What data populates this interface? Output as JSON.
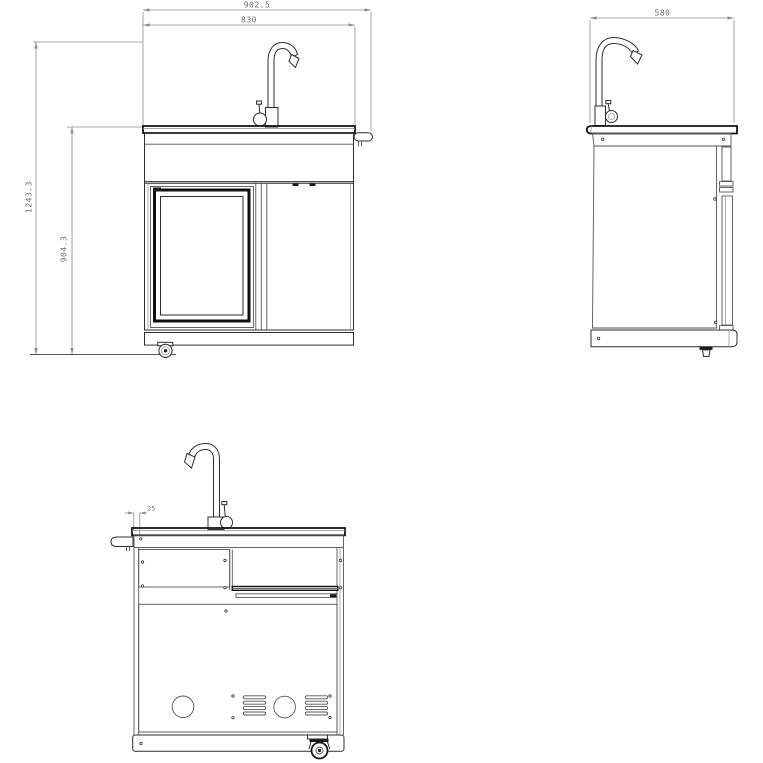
{
  "drawing": {
    "background_color": "#ffffff",
    "line_color": "#2d2d2d",
    "dim_line_color": "#8c8c8c",
    "dim_text_color": "#6e6e6e",
    "views": {
      "front": {
        "name": "front view - sink and fridge module",
        "dims": {
          "overall_width": "902.5",
          "cabinet_width": "830",
          "overall_height": "1243.3",
          "worktop_height": "904.3"
        }
      },
      "side": {
        "name": "side view",
        "dims": {
          "depth": "580"
        }
      },
      "rear": {
        "name": "rear view",
        "dims": {
          "panel_offset": "25"
        }
      }
    }
  }
}
